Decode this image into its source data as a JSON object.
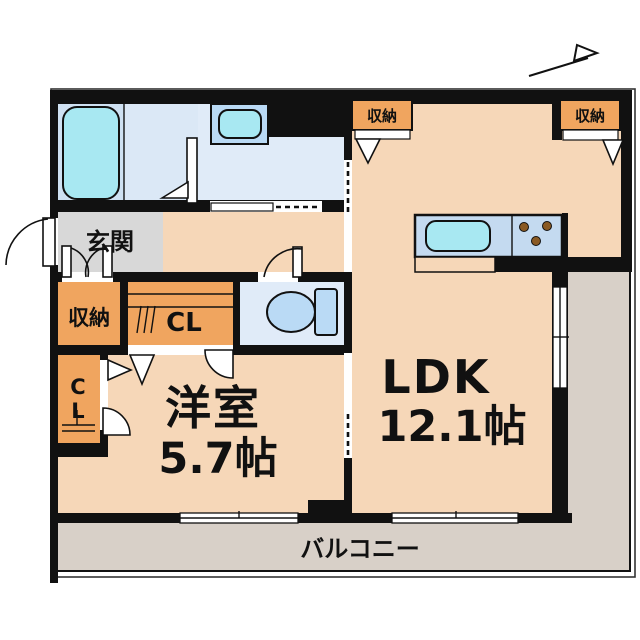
{
  "labels": {
    "genkan": "玄関",
    "storage_entrance": "収納",
    "closet_main": "CL",
    "closet_side_c": "C",
    "closet_side_l": "L",
    "bedroom_name": "洋室",
    "bedroom_size": "5.7帖",
    "ldk_name": "LDK",
    "ldk_size": "12.1帖",
    "storage_ldk_left": "収納",
    "storage_ldk_right": "収納",
    "balcony": "バルコニー"
  },
  "colors": {
    "wall": "#111111",
    "room_peach": "#f6d7b8",
    "closet_orange": "#f0a55f",
    "bath_blue": "#cfe1f2",
    "bath_blue2": "#dbe8f6",
    "wet_blue": "#e0ebf8",
    "genkan_gray": "#d8d8d8",
    "balcony_gray": "#d8d0c8",
    "fixture_blue": "#badaf5",
    "sink_cyan": "#a8e8f2",
    "counter_blue": "#c4daf0",
    "stove_brown": "#8a5a24"
  }
}
